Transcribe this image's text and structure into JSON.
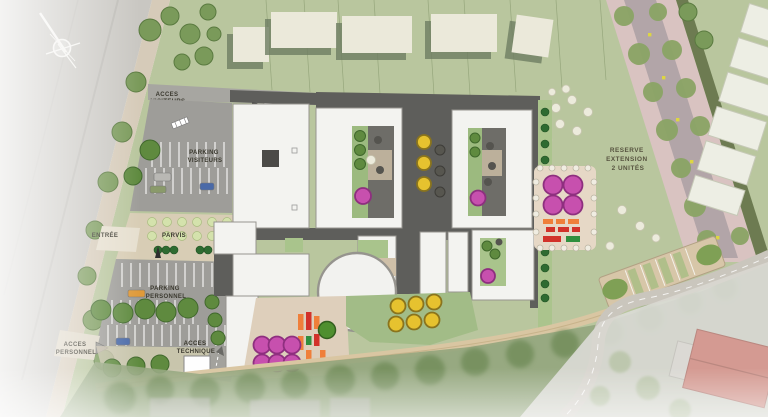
{
  "labels": {
    "acces_visiteurs": [
      "ACCES",
      "VISITEURS"
    ],
    "cour_de_service": [
      "COUR DE SERVICE"
    ],
    "parking_visiteurs": [
      "PARKING",
      "VISITEURS"
    ],
    "entree": [
      "ENTRÉE"
    ],
    "parvis": [
      "PARVIS"
    ],
    "parking_personnel": [
      "PARKING",
      "PERSONNEL"
    ],
    "acces_personnel": [
      "ACCES",
      "PERSONNEL"
    ],
    "acces_technique": [
      "ACCES",
      "TECHNIQUE"
    ],
    "reserve_extension": [
      "RESERVE",
      "EXTENSION",
      "2 UNITÉS"
    ]
  },
  "icons": {
    "compass": "north-arrow"
  },
  "palette": {
    "road_gray": "#c9c7c2",
    "sidewalk_tan": "#d6cbb9",
    "asphalt": "#9e9d99",
    "service_gray": "#a7a6a1",
    "roof_charcoal": "#5e5e5b",
    "building_white": "#f3f3f0",
    "building_stroke": "#97948f",
    "lawn": "#b9c69e",
    "lawn_belt": "#93a57d",
    "plaza_tan": "#d8cdb5",
    "path_tan": "#d9c6a2",
    "house_cream": "#ebe9da",
    "house_shadow": "#6e7d61",
    "tree_green": "#5f8a3f",
    "tree_street": "#7a9a5a",
    "tree_avenue": "#8aa364",
    "tree_light": "#d4e2ac",
    "bush_dark": "#2e6b31",
    "bush_white": "#ecebdc",
    "play_magenta": "#c750ae",
    "play_yellow": "#e6c22f",
    "play_orange": "#ef7f3a",
    "play_red": "#d2322a",
    "play_green": "#2f8f3e",
    "play_green_dark": "#4f8f2f",
    "avenue_pink": "#d9c3c1",
    "avenue_road": "#b2a5a8",
    "hedge_olive": "#6d7b51",
    "roof_red": "#c47468"
  }
}
